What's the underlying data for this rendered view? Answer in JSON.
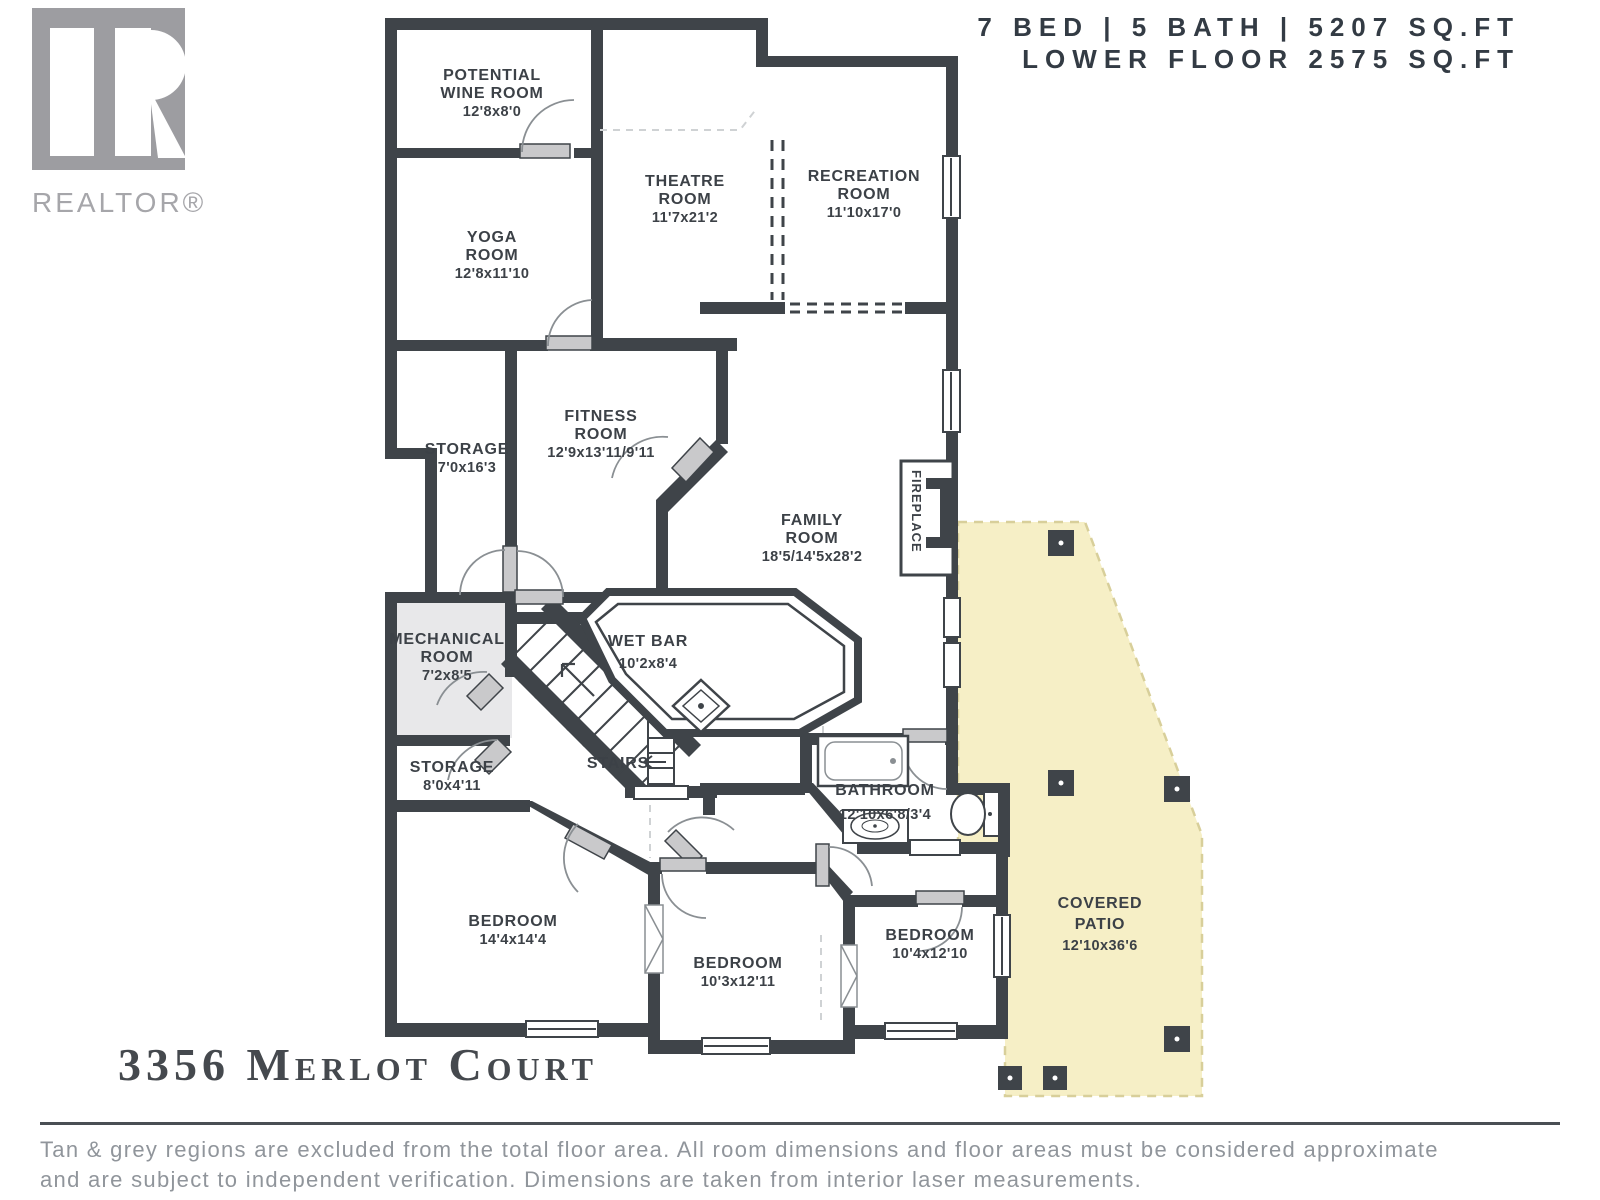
{
  "header": {
    "line1": "7 BED | 5 BATH | 5207 SQ.FT",
    "line2": "LOWER FLOOR 2575 SQ.FT"
  },
  "branding": {
    "logo_text": "REALTOR®"
  },
  "address": "3356 Merlot Court",
  "disclaimer": {
    "line1": "Tan & grey regions are excluded from the total floor area. All room dimensions and floor areas must be considered approximate",
    "line2": "and are subject to independent verification. Dimensions are taken from interior laser measurements."
  },
  "labels": {
    "fireplace": "FIREPLACE",
    "stairs": "STAIRS"
  },
  "rooms": [
    {
      "id": "potential-wine-room",
      "lines": [
        "POTENTIAL",
        "WINE ROOM",
        "12'8x8'0"
      ]
    },
    {
      "id": "yoga-room",
      "lines": [
        "YOGA",
        "ROOM",
        "12'8x11'10"
      ]
    },
    {
      "id": "theatre-room",
      "lines": [
        "THEATRE",
        "ROOM",
        "11'7x21'2"
      ]
    },
    {
      "id": "recreation-room",
      "lines": [
        "RECREATION",
        "ROOM",
        "11'10x17'0"
      ]
    },
    {
      "id": "storage-upper",
      "lines": [
        "STORAGE",
        "7'0x16'3"
      ]
    },
    {
      "id": "fitness-room",
      "lines": [
        "FITNESS",
        "ROOM",
        "12'9x13'11/9'11"
      ]
    },
    {
      "id": "family-room",
      "lines": [
        "FAMILY",
        "ROOM",
        "18'5/14'5x28'2"
      ]
    },
    {
      "id": "mechanical-room",
      "lines": [
        "MECHANICAL",
        "ROOM",
        "7'2x8'5"
      ]
    },
    {
      "id": "wet-bar",
      "lines": [
        "WET BAR",
        "10'2x8'4"
      ]
    },
    {
      "id": "storage-lower",
      "lines": [
        "STORAGE",
        "8'0x4'11"
      ]
    },
    {
      "id": "bathroom",
      "lines": [
        "BATHROOM",
        "12'10x6'8/3'4"
      ]
    },
    {
      "id": "bedroom-left",
      "lines": [
        "BEDROOM",
        "14'4x14'4"
      ]
    },
    {
      "id": "bedroom-middle",
      "lines": [
        "BEDROOM",
        "10'3x12'11"
      ]
    },
    {
      "id": "bedroom-right",
      "lines": [
        "BEDROOM",
        "10'4x12'10"
      ]
    },
    {
      "id": "covered-patio",
      "lines": [
        "COVERED",
        "PATIO",
        "12'10x36'6"
      ]
    }
  ],
  "colors": {
    "wall": "#3f4449",
    "patio_fill": "#f6efc6",
    "patio_border": "#d8cf9a",
    "grey_room_fill": "#e8e8ea",
    "door_leaf": "#c9c9cb",
    "text": "#3c4147",
    "disclaimer_text": "#90959b"
  }
}
